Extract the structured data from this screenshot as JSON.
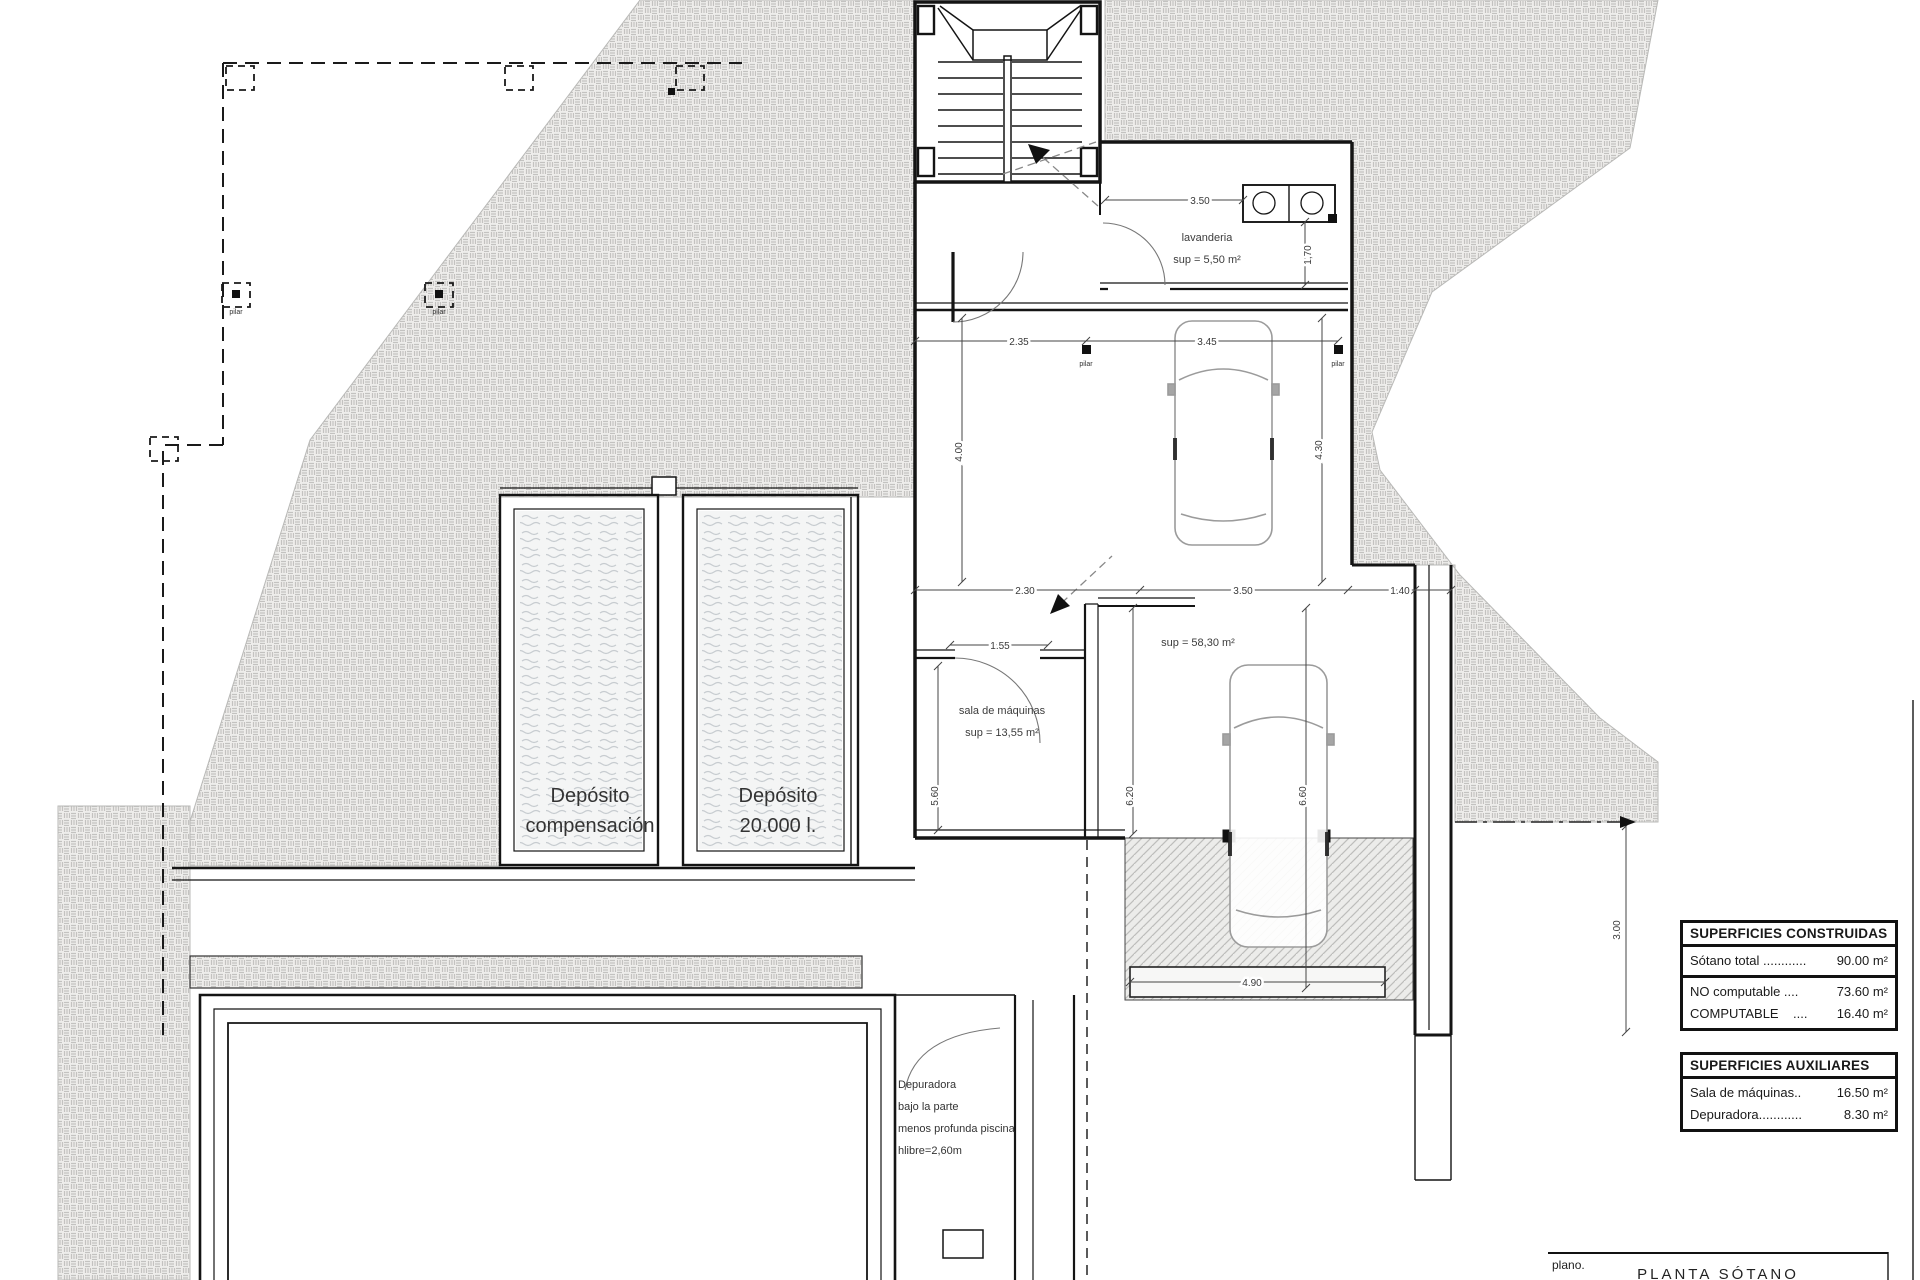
{
  "rooms": {
    "laundry": {
      "name": "lavanderia",
      "area": "sup = 5,50 m²"
    },
    "garage": {
      "area": "sup = 58,30 m²"
    },
    "machine_room": {
      "name": "sala de máquinas",
      "area": "sup = 13,55 m²"
    },
    "tank_compensation": {
      "line1": "Depósito",
      "line2": "compensación"
    },
    "tank_main": {
      "line1": "Depósito",
      "line2": "20.000 l."
    },
    "depuradora_note": {
      "line1": "Depuradora",
      "line2": "bajo la parte",
      "line3": "menos profunda piscina",
      "line4": "hlibre=2,60m"
    }
  },
  "dimensions": {
    "d350_top": "3.50",
    "d170": "1,70",
    "d235": "2.35",
    "d345": "3.45",
    "d400": "4.00",
    "d430": "4.30",
    "d230": "2.30",
    "d350_mid": "3.50",
    "d140": "1.40",
    "d155": "1.55",
    "d560": "5.60",
    "d620": "6.20",
    "d660": "6.60",
    "d490": "4.90",
    "d300": "3.00"
  },
  "markers": {
    "pilar": "pilar"
  },
  "tables": {
    "constructed": {
      "title": "SUPERFICIES CONSTRUIDAS",
      "rows": [
        {
          "label": "Sótano total ............",
          "value": "90.00 m²"
        }
      ],
      "rows2": [
        {
          "label": "NO computable ....",
          "value": "73.60 m²"
        },
        {
          "label": "COMPUTABLE    ....",
          "value": "16.40 m²"
        }
      ]
    },
    "auxiliary": {
      "title": "SUPERFICIES AUXILIARES",
      "rows": [
        {
          "label": "Sala de máquinas..",
          "value": "16.50 m²"
        },
        {
          "label": "Depuradora............",
          "value": "8.30 m²"
        }
      ]
    }
  },
  "title_block": {
    "label": "plano.",
    "value": "PLANTA SÓTANO"
  }
}
